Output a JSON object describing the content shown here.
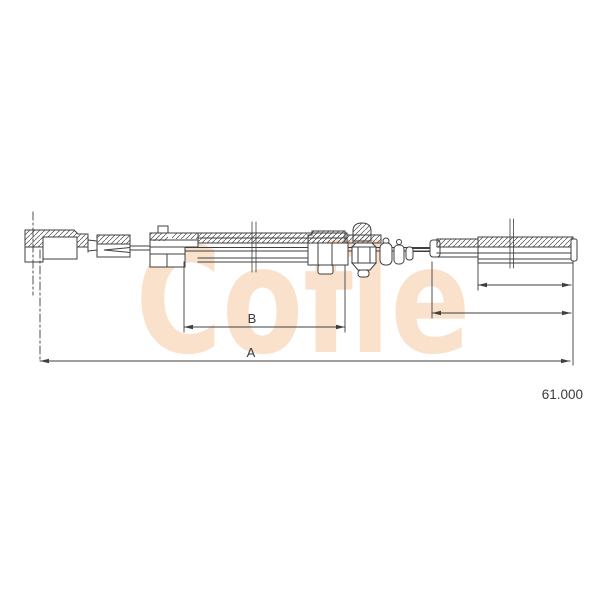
{
  "window": {
    "background_color": "#ffffff"
  },
  "drawing": {
    "watermark_text": "Cofle",
    "watermark_color": "#f5c9a4",
    "line_color": "#3f3f3f",
    "part_number": "61.000",
    "dim_a_label": "A",
    "dim_b_label": "B"
  }
}
